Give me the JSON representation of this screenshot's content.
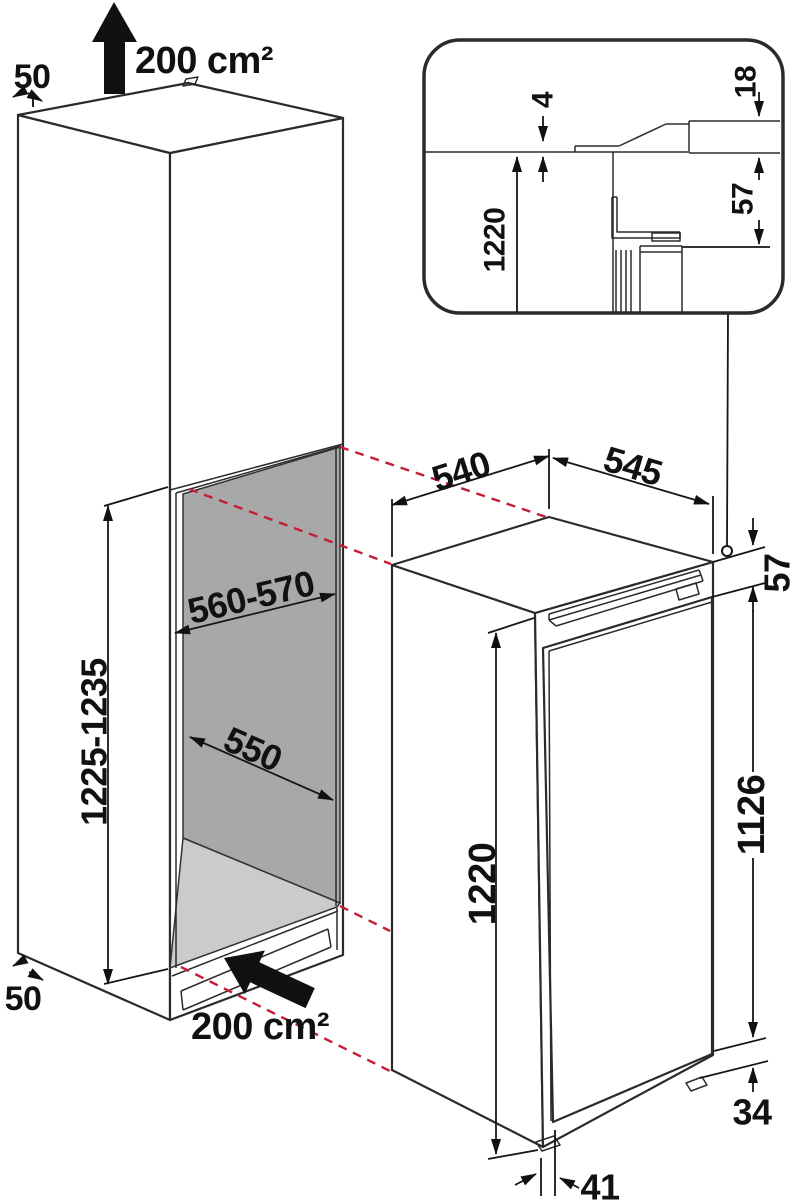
{
  "figure": {
    "kind": "built-in appliance installation dimension drawing",
    "units_note": "mm"
  },
  "colors": {
    "line": "#2b2b2b",
    "dim": "#161616",
    "red_dashed": "#c41d38",
    "niche_wall": "#a8a8a8",
    "niche_floor": "#cbcbcb",
    "arrow_fill": "#111111"
  },
  "cabinet": {
    "top_clearance": "50",
    "top_vent_area": "200 cm²",
    "niche_width": "560-570",
    "niche_height": "1225-1235",
    "niche_depth": "550",
    "bottom_clearance": "50",
    "bottom_vent_area": "200 cm²"
  },
  "appliance": {
    "width": "540",
    "depth": "545",
    "height": "1220",
    "door_height": "1126",
    "top_hinge_offset": "57",
    "plinth_height": "34",
    "door_thickness": "41"
  },
  "detail_inset": {
    "top_gap": "4",
    "panel_thickness": "18",
    "hinge_clearance": "57",
    "niche_height_ref": "1220"
  }
}
